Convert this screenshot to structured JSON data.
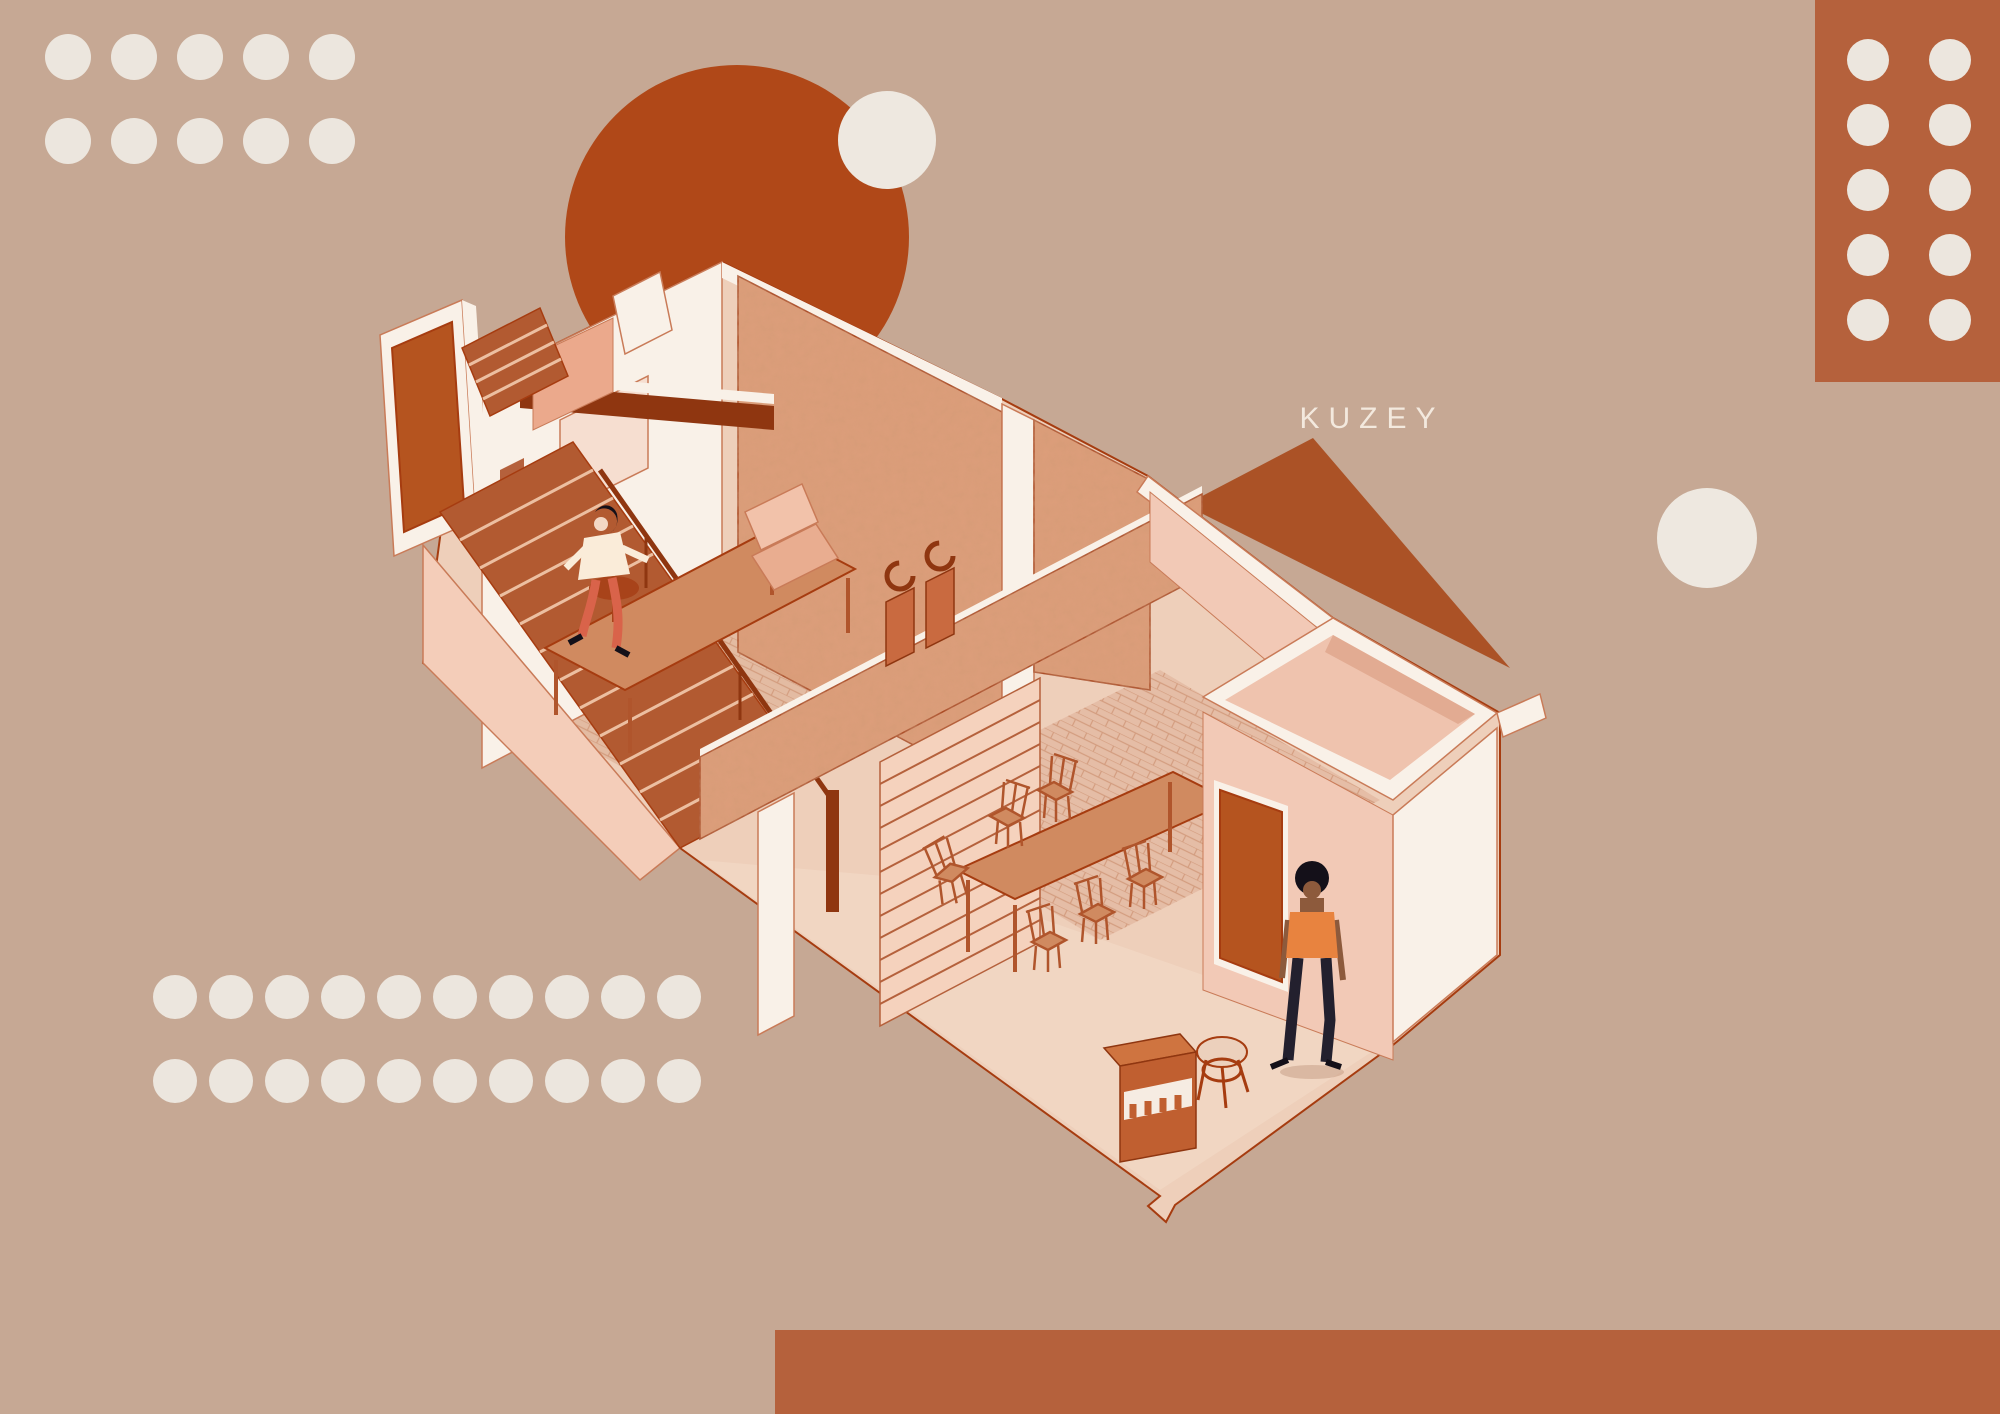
{
  "palette": {
    "background": "#c6a894",
    "dot_cream": "#ece6de",
    "circle_cream": "#eee8e0",
    "label_cream": "#f3e9de",
    "rust": "#b04818",
    "terracotta": "#b5613c",
    "triangle": "#ab5226",
    "wall_white": "#f9f1e8",
    "wall_edge": "#c97b58",
    "line_dark": "#a63c10",
    "floor": "#eecfba",
    "floor_light": "#f2d9c6",
    "brick": "#cf9576",
    "stone": "#dd9e7c",
    "stair": "#b25a31",
    "stair_step": "#ecbfa1",
    "beam": "#8f3610",
    "wood": "#d08a60",
    "wood_dark": "#b0552c",
    "salmon": "#eba98c",
    "pink_wall": "#f2c9b6",
    "door": "#b5541f",
    "skin_light": "#f3d7c4",
    "skin_dark": "#8d5a3c",
    "hair_dark": "#141019",
    "top_cream": "#faecd9",
    "top_orange": "#e8833f",
    "pants_red": "#d9634a",
    "pants_navy": "#23202e"
  },
  "scene": {
    "label_north": "KUZEY",
    "type": "isometric-cutaway-house-illustration",
    "objects": [
      "exterior-door-slab",
      "staircase",
      "stair-railing",
      "mezzanine-beam",
      "stone-back-wall",
      "stone-partition-wall",
      "slatted-screen",
      "armchair",
      "side-table",
      "sculptures",
      "work-table",
      "dining-table",
      "dining-chairs",
      "enclosed-room",
      "interior-door",
      "woman-descending-stairs",
      "woman-standing",
      "cabinet-with-awning",
      "stool",
      "north-triangle"
    ]
  },
  "decor": {
    "top_left_dot_grid": {
      "rows": 2,
      "cols": 5
    },
    "bottom_left_dot_grid": {
      "rows": 2,
      "cols": 10
    },
    "top_right_panel": {
      "dot_rows": 5,
      "dot_cols": 2
    },
    "big_circle": {
      "cx": 737,
      "cy": 237,
      "r": 172
    },
    "small_circle_top": {
      "cx": 887,
      "cy": 140,
      "r": 49
    },
    "small_circle_right": {
      "cx": 1707,
      "cy": 538,
      "r": 50
    },
    "bottom_right_bar": {
      "x": 775,
      "y": 1330,
      "w": 1225,
      "h": 84
    }
  }
}
